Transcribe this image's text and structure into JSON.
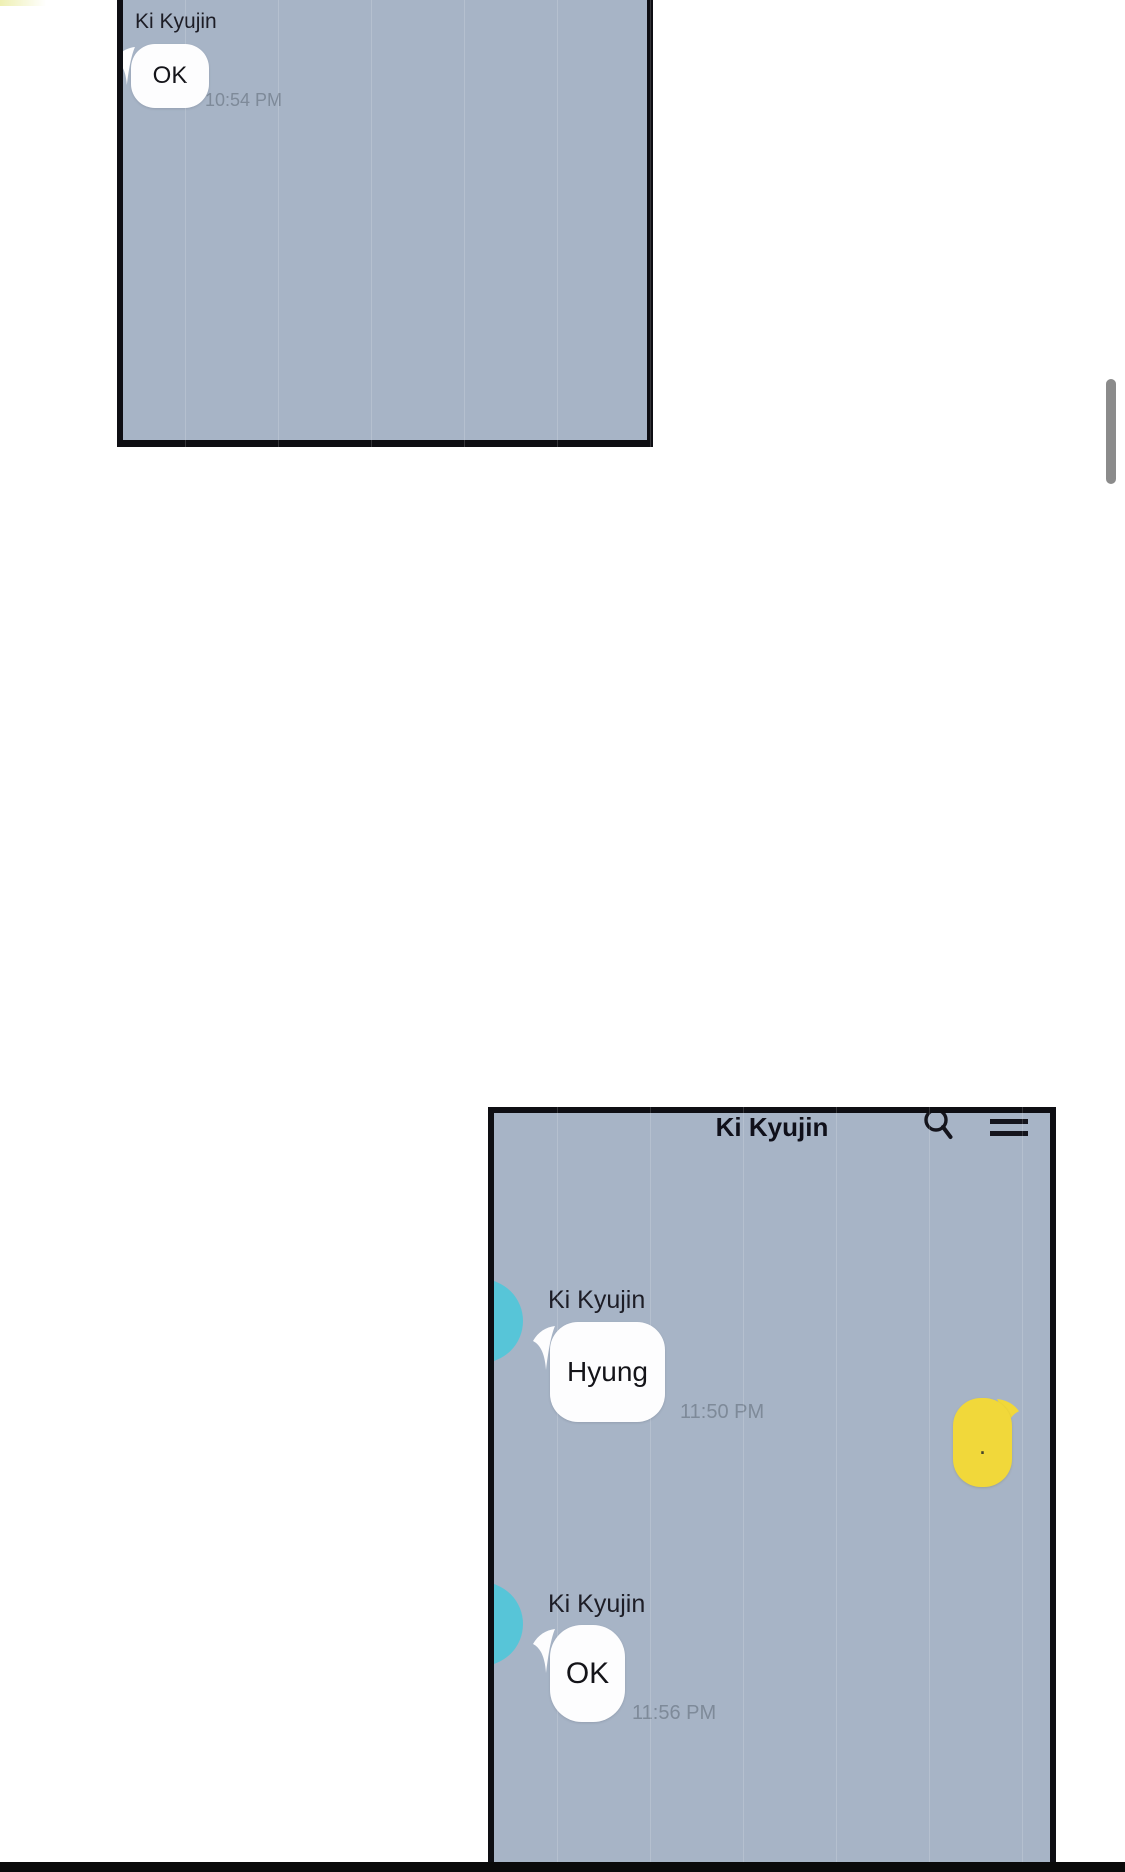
{
  "page": {
    "colors": {
      "panel_bg": "#a7b4c6",
      "border": "#0e0e13",
      "bubble_white": "#fdfdfe",
      "bubble_yellow": "#f1d83a",
      "avatar_cyan": "#57c5d8",
      "timestamp_gray": "#7e8a99",
      "text_dark": "#16161e",
      "scrollbar_gray": "#8b8b8b"
    }
  },
  "panel1": {
    "sender": "Ki Kyujin",
    "message": "OK",
    "time": "10:54 PM"
  },
  "panel2": {
    "header": {
      "title": "Ki Kyujin",
      "icons": [
        "search-icon",
        "menu-icon"
      ]
    },
    "messages": [
      {
        "sender": "Ki Kyujin",
        "text": "Hyung",
        "time": "11:50 PM",
        "side": "left"
      },
      {
        "text": ".",
        "side": "right"
      },
      {
        "sender": "Ki Kyujin",
        "text": "OK",
        "time": "11:56 PM",
        "side": "left"
      }
    ]
  }
}
